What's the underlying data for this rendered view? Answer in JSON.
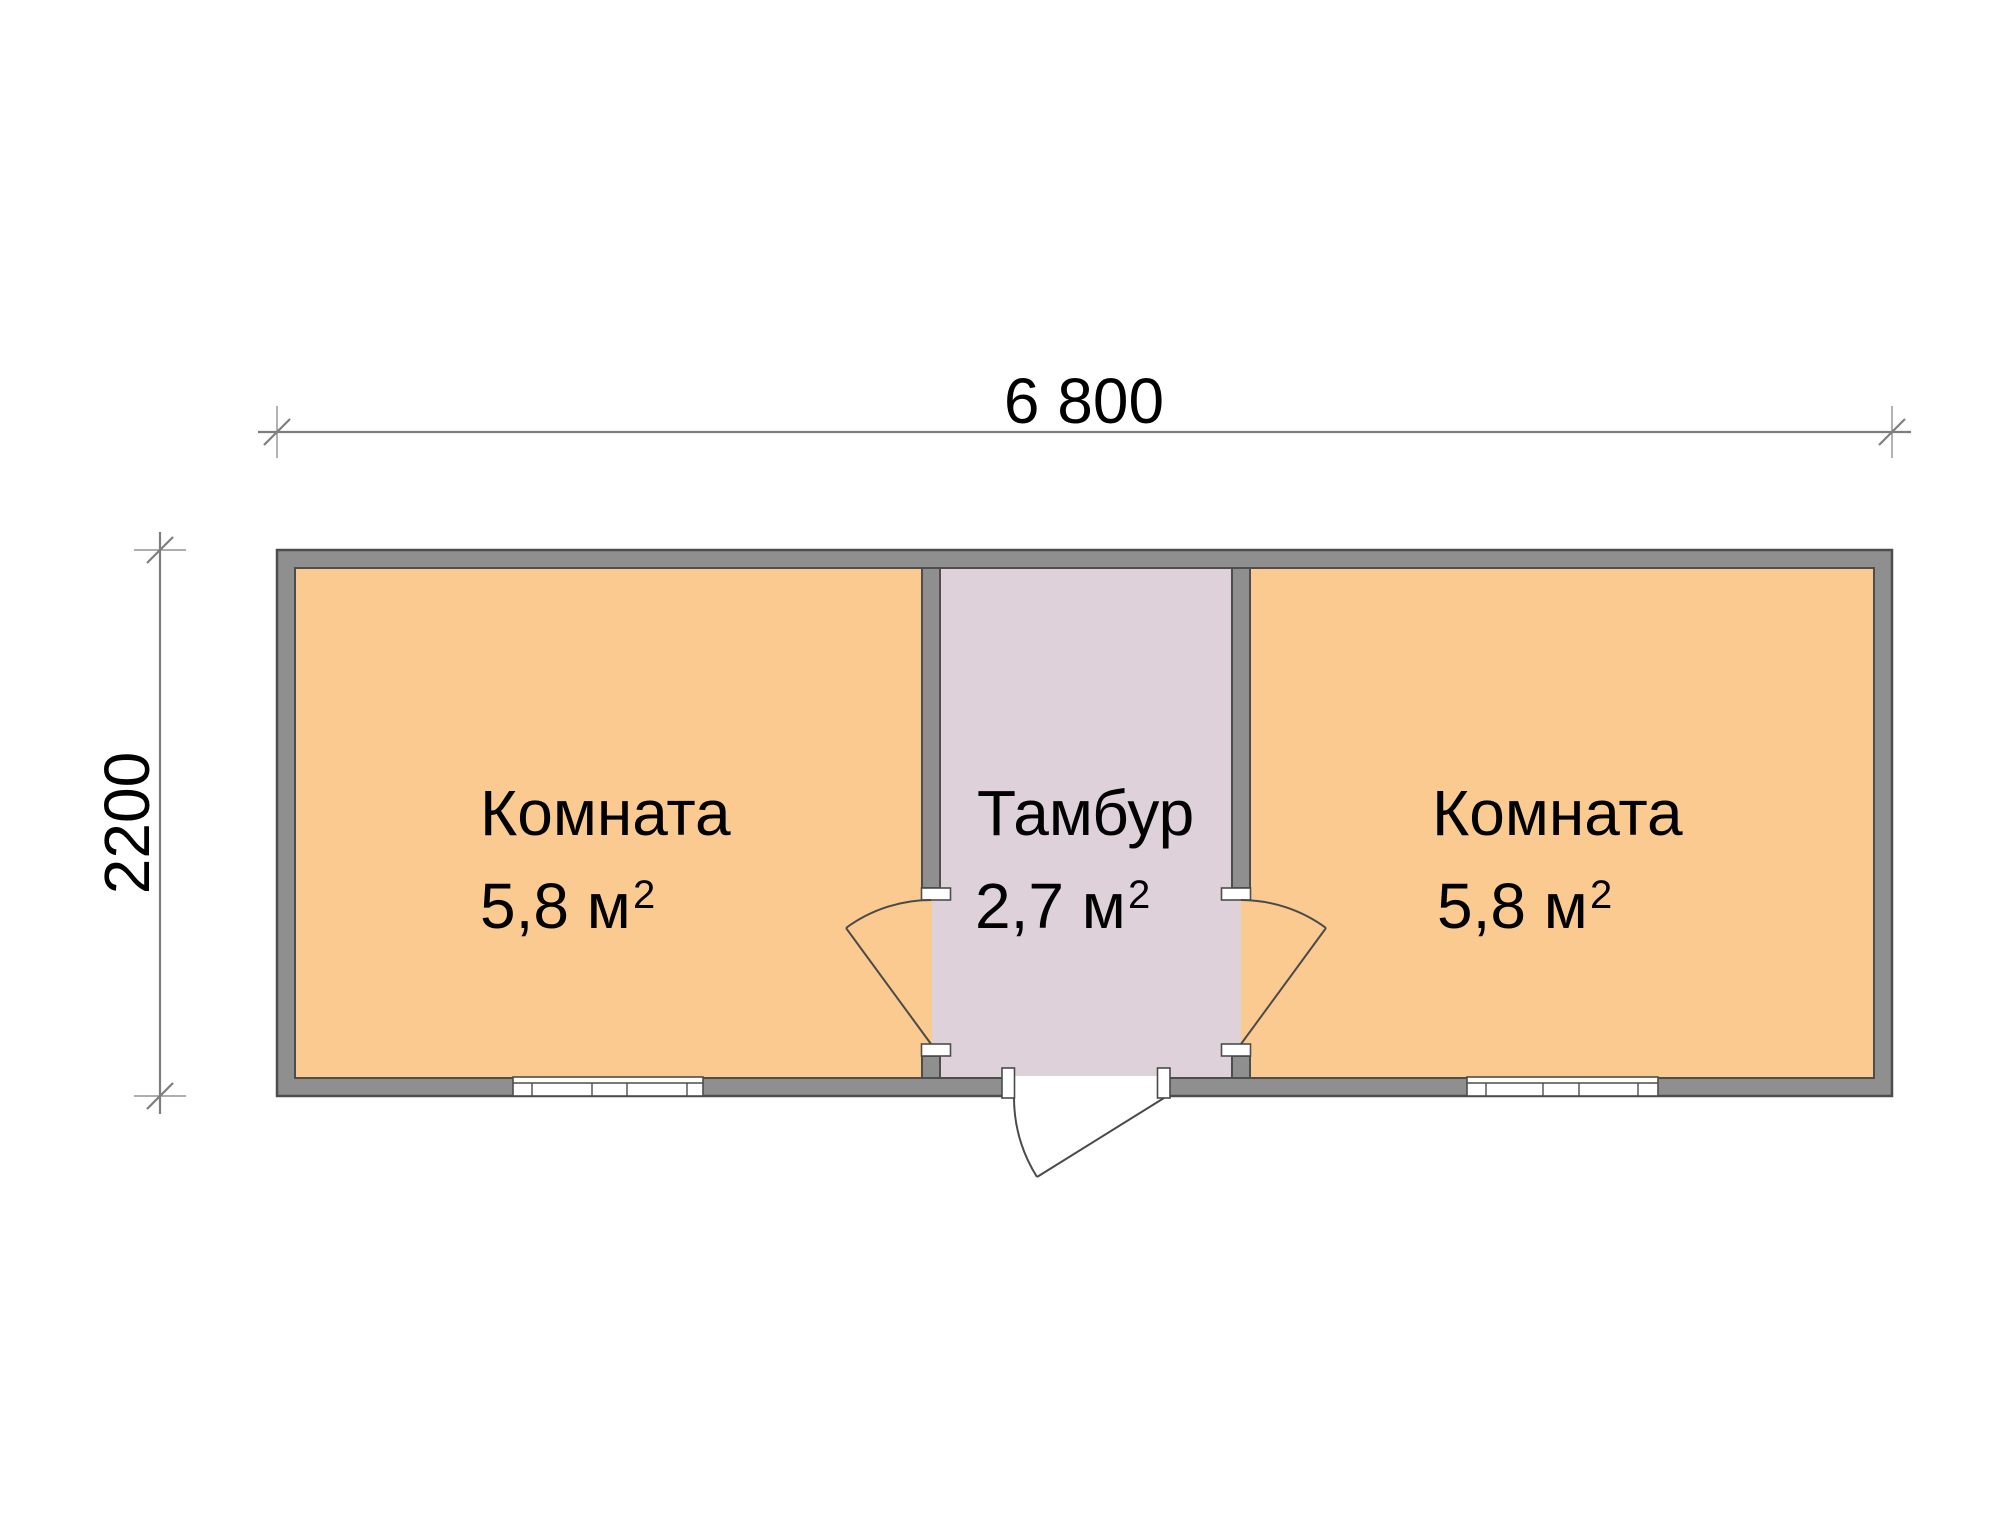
{
  "dimensions": {
    "width_label": "6 800",
    "height_label": "2200"
  },
  "rooms": [
    {
      "name": "Комната",
      "area": "5,8 м²",
      "area_base": "5,8 м",
      "area_exponent": "2"
    },
    {
      "name": "Тамбур",
      "area": "2,7 м²",
      "area_base": "2,7 м",
      "area_exponent": "2"
    },
    {
      "name": "Комната",
      "area": "5,8 м²",
      "area_base": "5,8 м",
      "area_exponent": "2"
    }
  ],
  "colors": {
    "room_fill": "#FBCA90",
    "vestibule_fill": "#DED1D9",
    "wall_fill": "#8F8F8F",
    "wall_outline": "#4D4D4D",
    "dimension_lines": "#7E7E7E",
    "door_lines": "#4A4A4A",
    "label_text": "#000000",
    "background": "#FFFFFF"
  }
}
